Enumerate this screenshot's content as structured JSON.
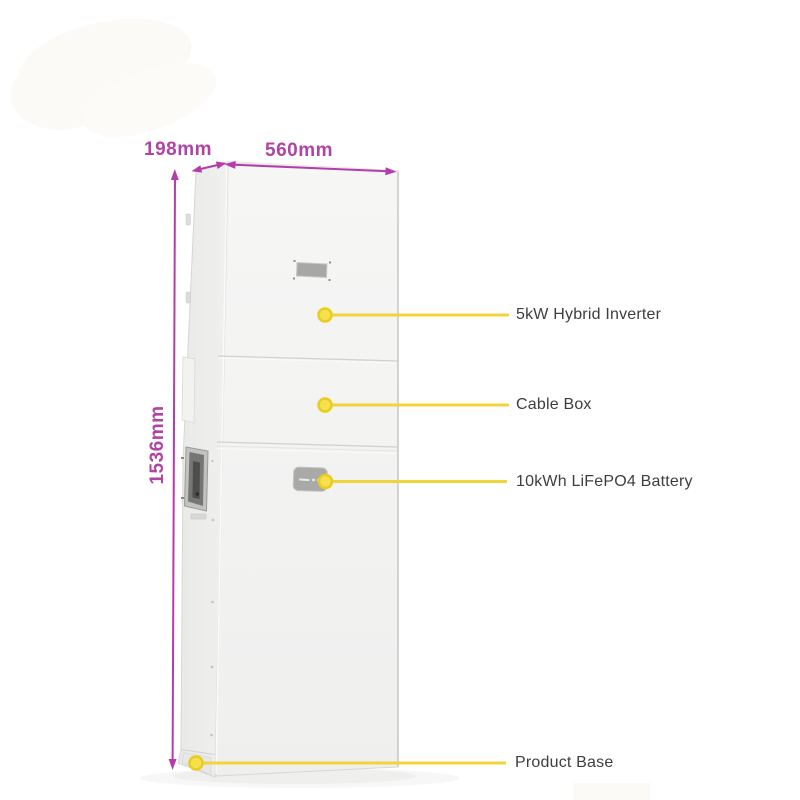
{
  "colors": {
    "background": "#ffffff",
    "dimension-accent": "#af44a3",
    "dimension-line": "#b43dab",
    "callout-line": "#f0d53a",
    "callout-dot-fill": "#f6e04e",
    "callout-dot-stroke": "#e8cd1d",
    "label-text": "#3e3e3e",
    "cabinet-front": "#f4f4f3",
    "cabinet-side": "#ededec",
    "cabinet-edge": "#d6d6d5"
  },
  "dimensions": {
    "depth": {
      "label": "198mm"
    },
    "width": {
      "label": "560mm"
    },
    "height": {
      "label": "1536mm"
    }
  },
  "callouts": {
    "inverter": {
      "label": "5kW Hybrid Inverter"
    },
    "cable_box": {
      "label": "Cable Box"
    },
    "battery": {
      "label": "10kWh LiFePO4 Battery"
    },
    "base": {
      "label": "Product Base"
    }
  }
}
